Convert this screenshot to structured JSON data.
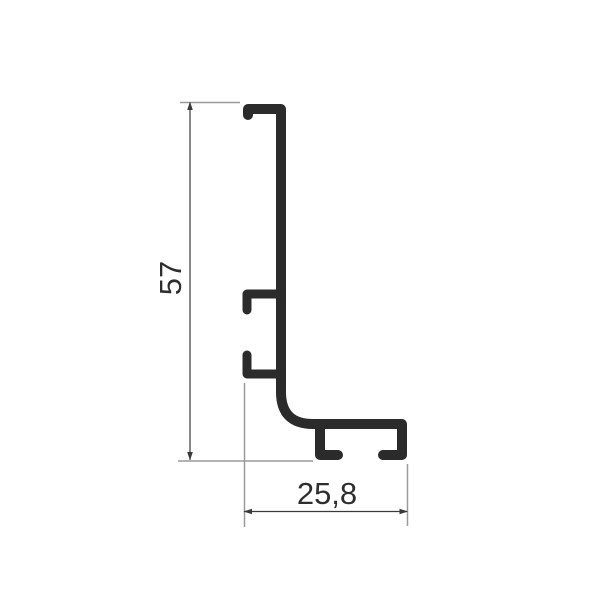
{
  "drawing": {
    "description": "Technical cross-section drawing of an L-shaped aluminum profile with dimension lines",
    "background_color": "#ffffff",
    "colors": {
      "profile": "#2b2b2b",
      "dimension_line": "#3a3a3a",
      "extension_line": "#9a9a9a",
      "label_text": "#2e2e2e"
    },
    "dimensions": {
      "height": {
        "value": "57"
      },
      "width": {
        "value": "25,8"
      }
    }
  }
}
